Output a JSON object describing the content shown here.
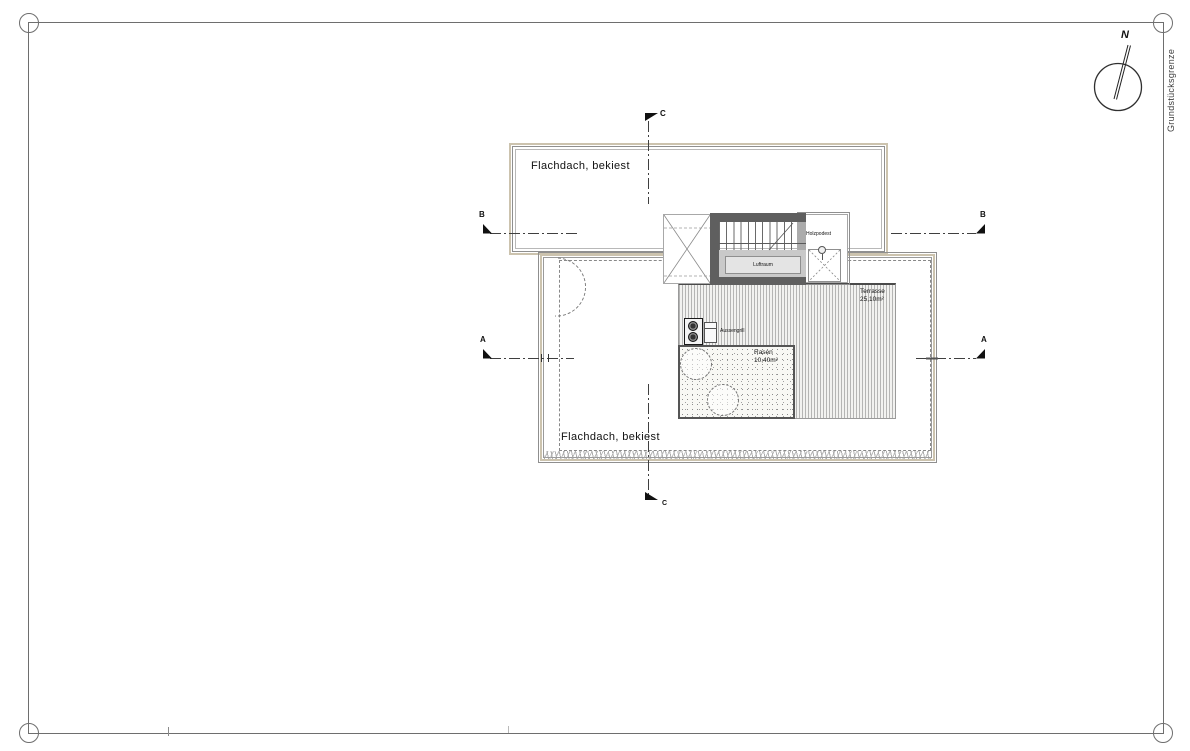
{
  "site": {
    "boundary_label": "Grundstücksgrenze",
    "north_label": "N"
  },
  "roofs": {
    "upper_label": "Flachdach, bekiest",
    "lower_label": "Flachdach, bekiest"
  },
  "terrace": {
    "name": "Terrasse",
    "area": "25,10m²"
  },
  "lawn": {
    "name": "Rasen",
    "area": "10,40m²"
  },
  "stair": {
    "air_space": "Luftraum"
  },
  "deck": {
    "label": "Holzpodest"
  },
  "grill": {
    "label": "Aussengrill"
  },
  "sections": {
    "a": "A",
    "b": "B",
    "c": "C"
  },
  "colors": {
    "roof_outline_tan": "#ccc3ae",
    "line_gray": "#8f8f8f",
    "dark_wall": "#5f5f5f",
    "section_line": "#3f3f3f",
    "lawn_border": "#555555",
    "background": "#ffffff"
  }
}
